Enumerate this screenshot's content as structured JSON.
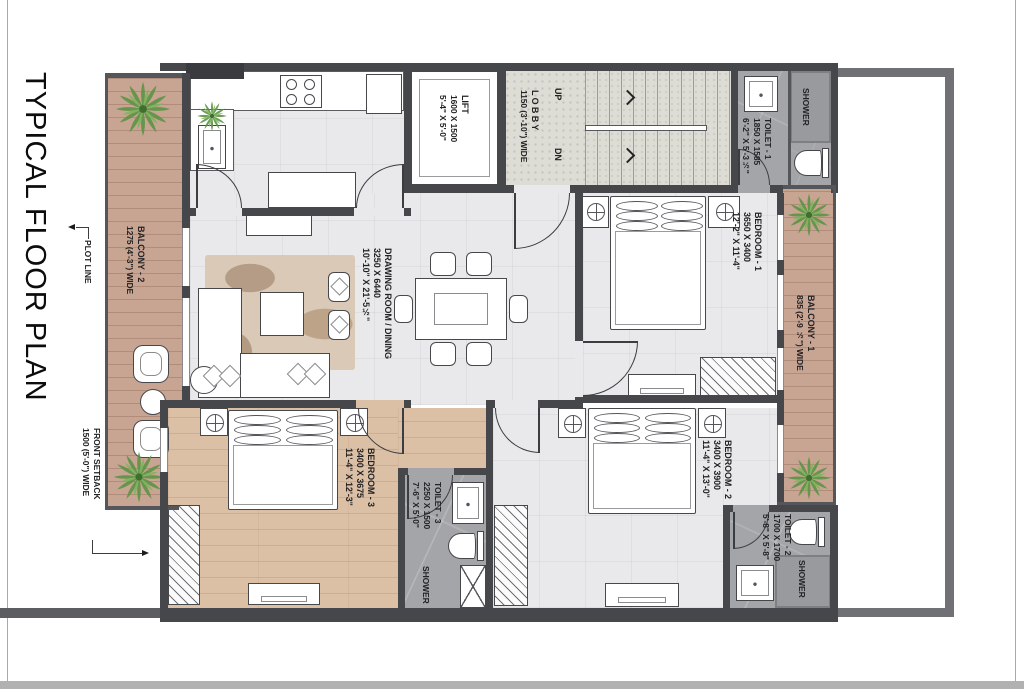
{
  "title": "TYPICAL FLOOR PLAN",
  "annotations": {
    "plot_line": "PLOT LINE",
    "front_setback_1": "FRONT SETBACK",
    "front_setback_2": "1500 (5'-0\") WIDE"
  },
  "rooms": {
    "balcony_2": {
      "name": "BALCONY - 2",
      "dim": "1275 (4'-3\") WIDE"
    },
    "lift": {
      "name": "LIFT",
      "dim_mm": "1600 X 1500",
      "dim_ft": "5'-4\" X 5'-0\""
    },
    "lobby": {
      "name": "L O B B Y",
      "dim": "1150 (3'-10\") WIDE"
    },
    "stairs": {
      "up": "UP",
      "dn": "DN"
    },
    "toilet_1": {
      "name": "TOILET - 1",
      "dim_mm": "1850 X 1585",
      "dim_ft": "6'-2\" X 5'-3½\""
    },
    "shower_1": {
      "name": "SHOWER"
    },
    "bedroom_1": {
      "name": "BEDROOM - 1",
      "dim_mm": "3650 X 3400",
      "dim_ft": "12'-2\" X 11'-4\""
    },
    "balcony_1": {
      "name": "BALCONY - 1",
      "dim": "835 (2'-9 ½\") WIDE"
    },
    "drawing_dining": {
      "name": "DRAWING ROOM / DINING",
      "dim_mm": "3250 X 6440",
      "dim_ft": "10'-10\" X 21'-5½\""
    },
    "bedroom_3": {
      "name": "BEDROOM - 3",
      "dim_mm": "3400 X 3675",
      "dim_ft": "11'-4\" X 12'-3\""
    },
    "toilet_3": {
      "name": "TOILET - 3",
      "dim_mm": "2250 X 1500",
      "dim_ft": "7'-6\" X 5'-0\""
    },
    "shower_3": {
      "name": "SHOWER"
    },
    "bedroom_2": {
      "name": "BEDROOM - 2",
      "dim_mm": "3400 X 3900",
      "dim_ft": "11'-4\" X 13'-0\""
    },
    "toilet_2": {
      "name": "TOILET - 2",
      "dim_mm": "1700 X 1700",
      "dim_ft": "5'-8\" X 5'-8\""
    },
    "shower_2": {
      "name": "SHOWER"
    }
  },
  "colors": {
    "wall": "#46474a",
    "compound_wall": "#707174",
    "tile_floor": "#e9e9eb",
    "granite_floor": "#dddcd5",
    "balcony_wood": "#c8a492",
    "bedroom_wood": "#dcc0a5",
    "toilet_tile": "#a4a5a9",
    "plant_green": "#5d9444"
  }
}
